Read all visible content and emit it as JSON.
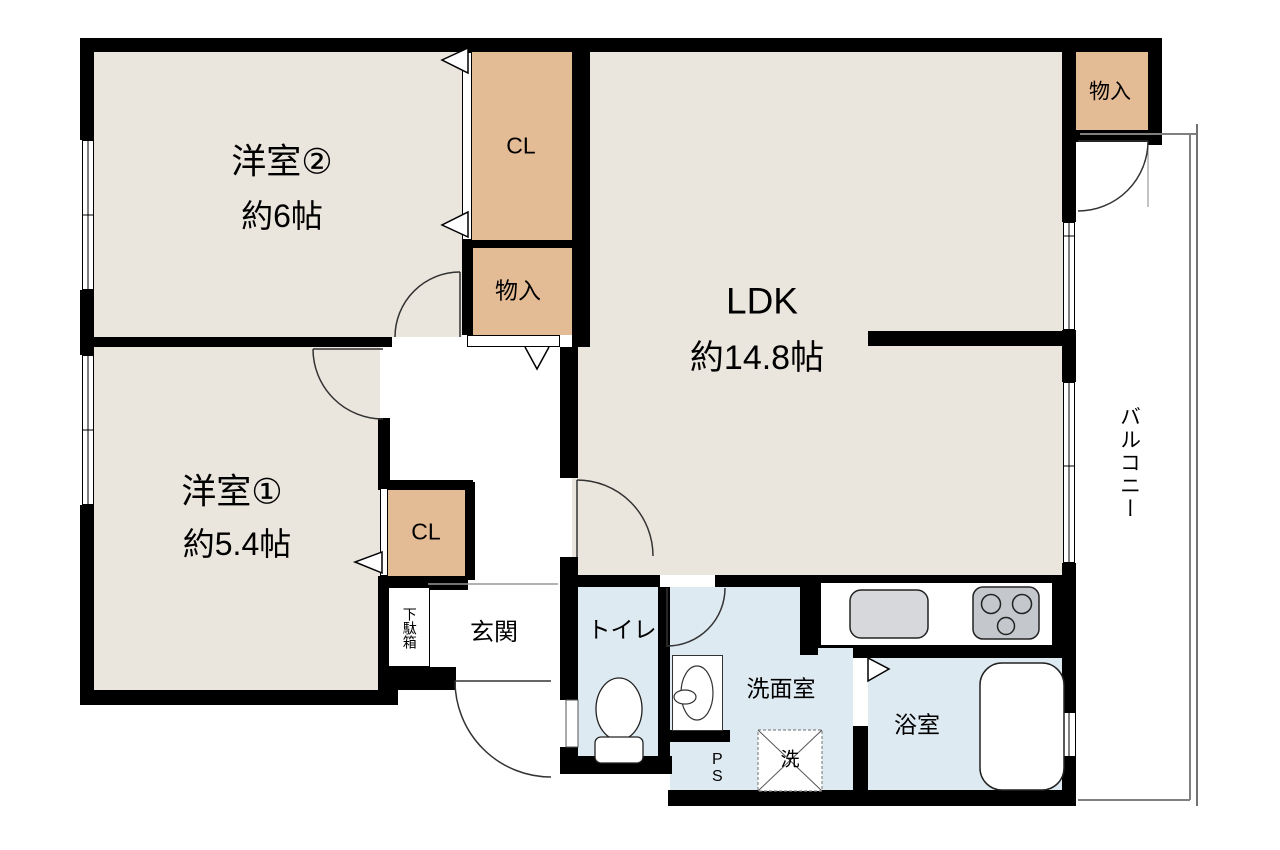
{
  "rooms": {
    "bedroom2": {
      "name": "洋室②",
      "size": "約6帖"
    },
    "bedroom1": {
      "name": "洋室①",
      "size": "約5.4帖"
    },
    "ldk": {
      "name": "LDK",
      "size": "約14.8帖"
    },
    "closet_top": {
      "label": "CL"
    },
    "closet_bedroom1": {
      "label": "CL"
    },
    "storage_mid": {
      "label": "物入"
    },
    "storage_balcony": {
      "label": "物入"
    },
    "entrance": {
      "label": "玄関"
    },
    "shoe_cabinet": {
      "label": "下駄箱"
    },
    "toilet": {
      "label": "トイレ"
    },
    "washroom": {
      "label": "洗面室"
    },
    "bathroom": {
      "label": "浴室"
    },
    "balcony": {
      "label": "バルコニー"
    },
    "pipe_space": {
      "label": "PS"
    },
    "washer": {
      "label": "洗"
    }
  },
  "colors": {
    "wall": "#000000",
    "room_fill": "#EAE5DD",
    "closet_fill": "#E3BB95",
    "water_fill": "#DEEAF2",
    "fixture_sink": "#D6D8DB",
    "fixture_stove": "#C4C8CC",
    "balcony_line": "#808080"
  }
}
